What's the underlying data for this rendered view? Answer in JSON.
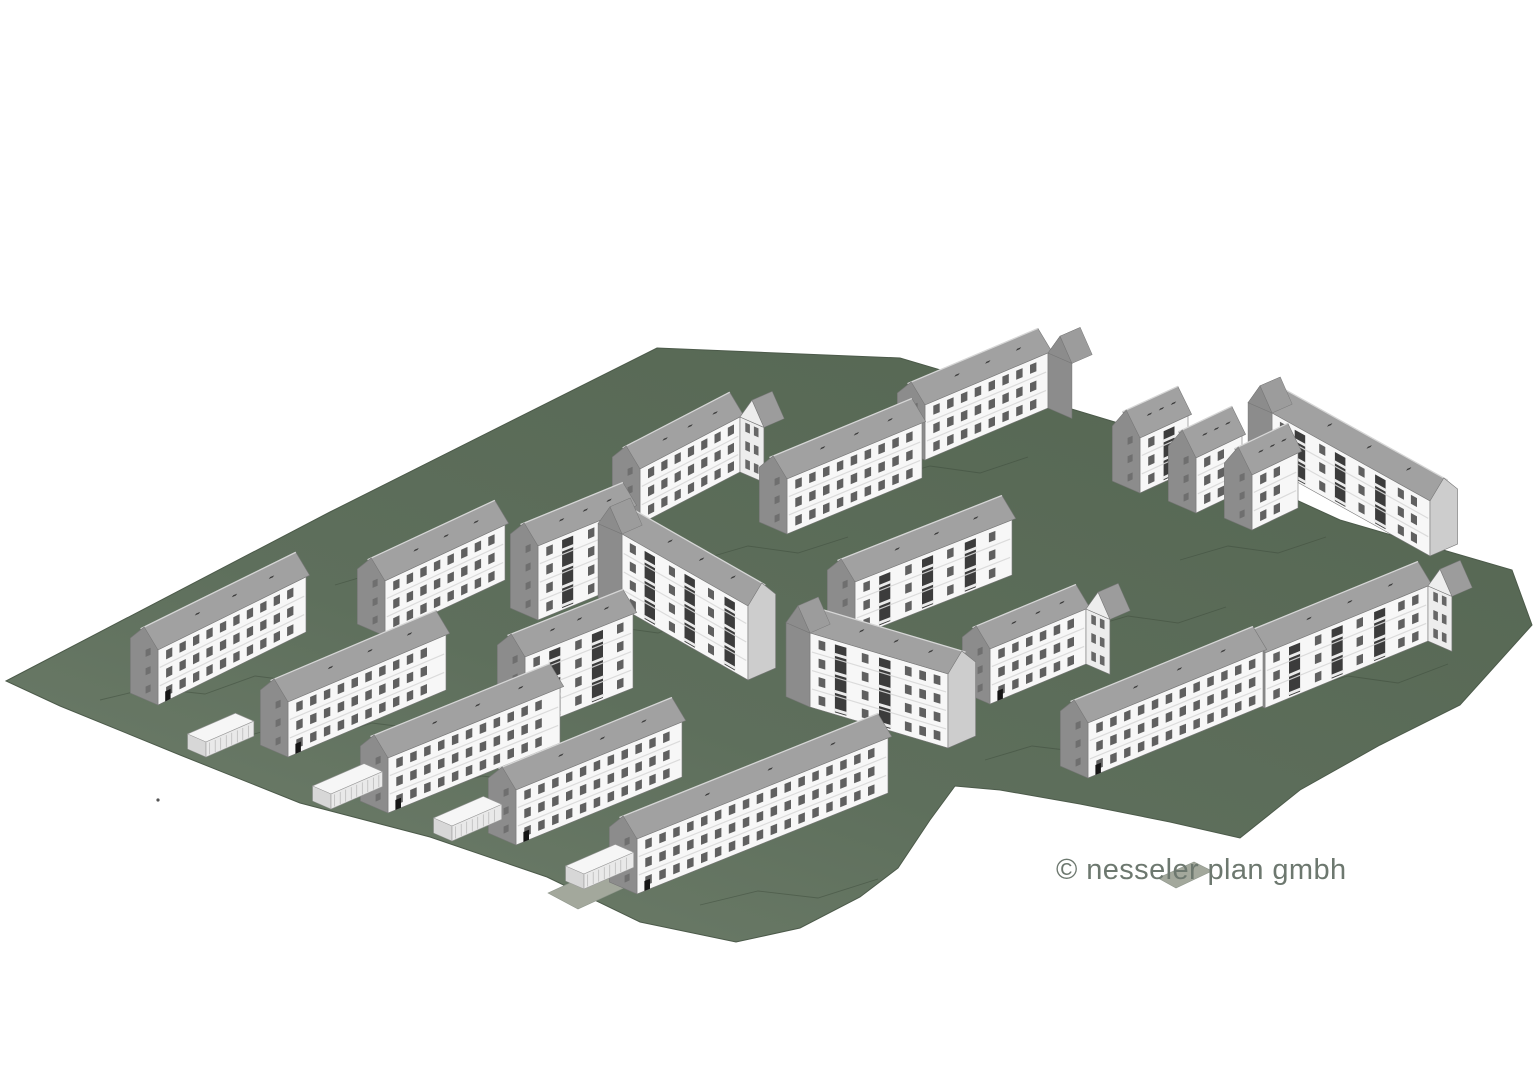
{
  "meta": {
    "copyright": "© nesseler plan gmbh",
    "title": "housing estate massing model"
  },
  "canvas": {
    "width": 1536,
    "height": 1075,
    "background": "#ffffff"
  },
  "colors": {
    "background": "#ffffff",
    "site": "#5e6f5c",
    "site_light": "#72816e",
    "site_dark": "#566753",
    "site_edge": "#4c5a4a",
    "contour": "#3e4c3c",
    "path": "#a3a89c",
    "roof": "#a1a1a1",
    "ridge": "#d6d6d6",
    "edge": "#787878",
    "facade": "#f7f7f7",
    "window": "#454545",
    "balcony": "#2b2b2b",
    "slab": "#ebebeb",
    "floor_line": "#d9d9d9",
    "gable_shadow": "#8c8c8c",
    "gable_light": "#cdcdcd",
    "wing_light": "#ededed",
    "garage_top": "#f6f6f6",
    "garage_front": "#e9e9e9",
    "garage_stripe": "#b5b5b5",
    "text": "#6d786f"
  },
  "site": {
    "outline": [
      [
        6,
        681
      ],
      [
        330,
        512
      ],
      [
        657,
        348
      ],
      [
        900,
        358
      ],
      [
        1035,
        398
      ],
      [
        1148,
        432
      ],
      [
        1340,
        520
      ],
      [
        1512,
        570
      ],
      [
        1532,
        625
      ],
      [
        1460,
        705
      ],
      [
        1380,
        745
      ],
      [
        1300,
        790
      ],
      [
        1240,
        838
      ],
      [
        1170,
        822
      ],
      [
        1080,
        804
      ],
      [
        1000,
        790
      ],
      [
        955,
        786
      ],
      [
        930,
        820
      ],
      [
        898,
        868
      ],
      [
        860,
        897
      ],
      [
        800,
        928
      ],
      [
        736,
        942
      ],
      [
        640,
        922
      ],
      [
        547,
        877
      ],
      [
        430,
        837
      ],
      [
        300,
        803
      ],
      [
        180,
        755
      ],
      [
        60,
        706
      ]
    ],
    "dot": [
      158,
      800
    ],
    "contours": [
      [
        [
          100,
          700
        ],
        [
          150,
          688
        ],
        [
          205,
          694
        ],
        [
          255,
          676
        ],
        [
          295,
          681
        ]
      ],
      [
        [
          215,
          745
        ],
        [
          265,
          731
        ],
        [
          322,
          739
        ],
        [
          372,
          723
        ],
        [
          420,
          729
        ]
      ],
      [
        [
          432,
          790
        ],
        [
          482,
          776
        ],
        [
          540,
          783
        ],
        [
          592,
          767
        ]
      ],
      [
        [
          335,
          585
        ],
        [
          382,
          571
        ],
        [
          432,
          578
        ],
        [
          470,
          562
        ]
      ],
      [
        [
          560,
          640
        ],
        [
          608,
          626
        ],
        [
          658,
          633
        ],
        [
          700,
          618
        ]
      ],
      [
        [
          700,
          560
        ],
        [
          748,
          546
        ],
        [
          798,
          553
        ],
        [
          848,
          537
        ]
      ],
      [
        [
          882,
          480
        ],
        [
          930,
          466
        ],
        [
          980,
          473
        ],
        [
          1028,
          457
        ]
      ],
      [
        [
          1180,
          560
        ],
        [
          1228,
          546
        ],
        [
          1278,
          553
        ],
        [
          1326,
          537
        ]
      ],
      [
        [
          985,
          760
        ],
        [
          1032,
          746
        ],
        [
          1090,
          753
        ],
        [
          1148,
          737
        ]
      ],
      [
        [
          1300,
          690
        ],
        [
          1348,
          676
        ],
        [
          1398,
          683
        ],
        [
          1448,
          664
        ]
      ],
      [
        [
          700,
          905
        ],
        [
          758,
          891
        ],
        [
          818,
          898
        ],
        [
          878,
          879
        ]
      ],
      [
        [
          1080,
          630
        ],
        [
          1128,
          616
        ],
        [
          1178,
          623
        ],
        [
          1226,
          607
        ]
      ]
    ]
  },
  "paths": [
    [
      [
        548,
        893
      ],
      [
        596,
        871
      ],
      [
        626,
        887
      ],
      [
        578,
        909
      ]
    ],
    [
      [
        1158,
        878
      ],
      [
        1194,
        862
      ],
      [
        1212,
        871
      ],
      [
        1176,
        888
      ]
    ]
  ],
  "buildings": [
    {
      "id": "row-north-east",
      "type": "ne",
      "base": [
        925,
        460,
        1048,
        408
      ],
      "floors": 3,
      "balconies": false,
      "wing": "right",
      "wing_shade": "dark",
      "door": false
    },
    {
      "id": "row-north-west",
      "type": "ne",
      "base": [
        640,
        524,
        740,
        472
      ],
      "floors": 3,
      "balconies": false,
      "wing": "right",
      "wing_shade": "light",
      "door": false
    },
    {
      "id": "row-north-mid",
      "type": "ne",
      "base": [
        787,
        534,
        922,
        478
      ],
      "floors": 3,
      "balconies": false,
      "wing": "none",
      "wing_shade": "dark",
      "door": false
    },
    {
      "id": "row-east-upper",
      "type": "se",
      "base": [
        1272,
        468,
        1430,
        556
      ],
      "floors": 3,
      "balconies": true,
      "wing": "left",
      "wing_shade": "dark",
      "door": false
    },
    {
      "id": "house-east-1",
      "type": "ne",
      "base": [
        1140,
        493,
        1188,
        471
      ],
      "floors": 3,
      "balconies": true,
      "wing": "none",
      "wing_shade": "dark",
      "door": false,
      "rr": 22
    },
    {
      "id": "house-east-2",
      "type": "ne",
      "base": [
        1196,
        513,
        1242,
        491
      ],
      "floors": 3,
      "balconies": true,
      "wing": "none",
      "wing_shade": "dark",
      "door": false,
      "rr": 22
    },
    {
      "id": "house-east-3",
      "type": "ne",
      "base": [
        1252,
        530,
        1298,
        508
      ],
      "floors": 3,
      "balconies": true,
      "wing": "none",
      "wing_shade": "dark",
      "door": false,
      "rr": 22
    },
    {
      "id": "row-west-upper",
      "type": "ne",
      "base": [
        385,
        636,
        505,
        580
      ],
      "floors": 3,
      "balconies": false,
      "wing": "none",
      "wing_shade": "dark",
      "door": false
    },
    {
      "id": "block-center-north",
      "type": "ne",
      "base": [
        538,
        620,
        633,
        581
      ],
      "floors": 4,
      "balconies": true,
      "wing": "none",
      "wing_shade": "dark",
      "door": false
    },
    {
      "id": "row-center-east",
      "type": "ne",
      "base": [
        855,
        637,
        1012,
        575
      ],
      "floors": 3,
      "balconies": true,
      "wing": "none",
      "wing_shade": "dark",
      "door": false
    },
    {
      "id": "block-center-a",
      "type": "se",
      "base": [
        622,
        608,
        748,
        680
      ],
      "floors": 4,
      "balconies": true,
      "wing": "left",
      "wing_shade": "dark",
      "door": false
    },
    {
      "id": "row-west-1",
      "type": "ne",
      "base": [
        158,
        705,
        306,
        632
      ],
      "floors": 3,
      "balconies": false,
      "wing": "none",
      "wing_shade": "dark",
      "door": true
    },
    {
      "id": "row-southeast-b",
      "type": "ne",
      "base": [
        1265,
        708,
        1428,
        641
      ],
      "floors": 3,
      "balconies": true,
      "wing": "right",
      "wing_shade": "light",
      "door": false
    },
    {
      "id": "row-center-south",
      "type": "ne",
      "base": [
        990,
        704,
        1086,
        664
      ],
      "floors": 3,
      "balconies": false,
      "wing": "right",
      "wing_shade": "light",
      "door": true
    },
    {
      "id": "block-center-b",
      "type": "ne",
      "base": [
        525,
        731,
        633,
        688
      ],
      "floors": 4,
      "balconies": true,
      "wing": "none",
      "wing_shade": "dark",
      "door": false
    },
    {
      "id": "row-west-2",
      "type": "ne",
      "base": [
        288,
        757,
        446,
        690
      ],
      "floors": 3,
      "balconies": false,
      "wing": "none",
      "wing_shade": "dark",
      "door": true
    },
    {
      "id": "block-center-c",
      "type": "se",
      "base": [
        810,
        707,
        948,
        748
      ],
      "floors": 4,
      "balconies": true,
      "wing": "left",
      "wing_shade": "dark",
      "door": false
    },
    {
      "id": "row-southeast-a",
      "type": "ne",
      "base": [
        1088,
        778,
        1263,
        706
      ],
      "floors": 3,
      "balconies": false,
      "wing": "none",
      "wing_shade": "dark",
      "door": true
    },
    {
      "id": "row-west-3",
      "type": "ne",
      "base": [
        388,
        813,
        560,
        743
      ],
      "floors": 3,
      "balconies": false,
      "wing": "none",
      "wing_shade": "dark",
      "door": true
    },
    {
      "id": "row-west-4",
      "type": "ne",
      "base": [
        516,
        845,
        682,
        777
      ],
      "floors": 3,
      "balconies": false,
      "wing": "none",
      "wing_shade": "dark",
      "door": true
    },
    {
      "id": "row-south",
      "type": "ne",
      "base": [
        637,
        894,
        888,
        793
      ],
      "floors": 3,
      "balconies": false,
      "wing": "none",
      "wing_shade": "dark",
      "door": true
    }
  ],
  "garages": [
    {
      "x": 206,
      "y": 757,
      "len": 52
    },
    {
      "x": 331,
      "y": 809,
      "len": 56
    },
    {
      "x": 452,
      "y": 841,
      "len": 54
    },
    {
      "x": 584,
      "y": 889,
      "len": 54
    }
  ]
}
